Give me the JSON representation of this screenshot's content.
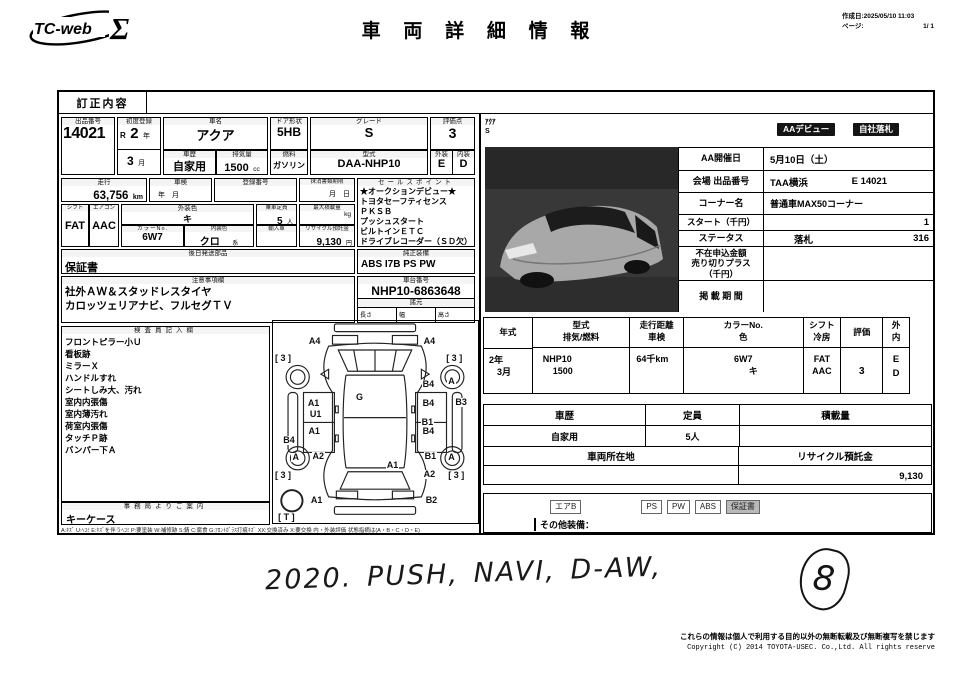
{
  "header": {
    "logo_text": "TC-web",
    "logo_sigma": "Σ",
    "title": "車 両 詳 細 情 報",
    "created": "作成日:2025/05/10 11:03",
    "page_label": "ページ:",
    "page_value": "1/ 1"
  },
  "correction": {
    "label": "訂正内容"
  },
  "left": {
    "exhibit_no": {
      "label": "出品番号",
      "value": "14021"
    },
    "first_reg": {
      "label": "初度登録",
      "era": "R",
      "year": "2",
      "year_unit": "年",
      "month": "3",
      "month_unit": "月"
    },
    "car_name": {
      "label": "車名",
      "value": "アクア"
    },
    "door": {
      "label": "ドア形状",
      "value": "5HB"
    },
    "grade": {
      "label": "グレード",
      "value": "S"
    },
    "score": {
      "label": "評価点",
      "value": "3"
    },
    "ext_grade": {
      "label": "外装",
      "value": "E"
    },
    "int_grade": {
      "label": "内装",
      "value": "D"
    },
    "history": {
      "label": "車歴",
      "value": "自家用"
    },
    "displacement": {
      "label": "排気量",
      "value": "1500",
      "unit": "cc"
    },
    "fuel": {
      "label": "燃料",
      "value": "ガソリン"
    },
    "model": {
      "label": "型式",
      "value": "DAA-NHP10"
    },
    "mileage": {
      "label": "走行",
      "value": "63,756",
      "unit": "km"
    },
    "shaken": {
      "label": "車検",
      "value": "年　月"
    },
    "reg_no": {
      "label": "登録番号",
      "value": ""
    },
    "doc_limit": {
      "label": "抹消書類期限",
      "value": "月　日"
    },
    "sales_points": {
      "label": "セールスポイント",
      "lines": [
        "★オークションデビュー★",
        "トヨタセーフティセンス",
        "ＰＫＳＢ",
        "プッシュスタート",
        "ビルトインＥＴＣ",
        "ドライブレコーダー（ＳＤ欠）"
      ]
    },
    "shift": {
      "label": "シフト",
      "value": "FAT"
    },
    "aircon": {
      "label": "エアコン",
      "value": "AAC"
    },
    "ext_color": {
      "label": "外装色",
      "value": "キ"
    },
    "capacity": {
      "label": "乗車定員",
      "value": "5",
      "unit": "人"
    },
    "max_load": {
      "label": "最大積載量",
      "unit": "kg"
    },
    "color_no": {
      "label": "カラーNo.",
      "value": "6W7"
    },
    "int_color": {
      "label": "内装色",
      "value": "クロ",
      "unit": "系"
    },
    "imported": {
      "label": "輸入車",
      "value": ""
    },
    "recycle_fee": {
      "label": "リサイクル預託金",
      "value": "9,130",
      "unit": "円"
    },
    "later_parts": {
      "label": "後日発送部品",
      "value": "保証書"
    },
    "factory_equip": {
      "label": "純正装備",
      "value": "ABS I7B PS PW"
    },
    "notes": {
      "label": "注意事項欄",
      "lines": [
        "社外ＡＷ＆スタッドレスタイヤ",
        "カロッツェリアナビ、フルセグＴＶ"
      ]
    },
    "chassis": {
      "label": "車台番号",
      "value": "NHP10-6863648"
    },
    "dims": {
      "label": "諸元",
      "length": "長さ",
      "width": "幅",
      "height": "高さ"
    },
    "inspector": {
      "label": "検査員記入欄",
      "lines": [
        "フロントピラー小Ｕ",
        "看板跡",
        "ミラーＸ",
        "ハンドルすれ",
        "シートしみ大、汚れ",
        "室内内張傷",
        "室内薄汚れ",
        "荷室内張傷",
        "タッチＰ跡",
        "バンパー下Ａ"
      ]
    },
    "office": {
      "label": "事務局よりご案内",
      "value": "キーケース"
    },
    "legend": "A:ｷｽﾞ U:ﾍｺﾐ E:ｷｽﾞを伴うﾍｺﾐ P:要塗装 W:補修跡 S:錆 C:腐食 G:ﾌﾛﾝﾄｶﾞﾗｽ打痕ｷｽﾞ XX:交換済み X:要交換  内・外装評価  状態指摘は(A・B・C・D・E)"
  },
  "diagram": {
    "marks": [
      {
        "t": "A4",
        "x": 17,
        "y": 8
      },
      {
        "t": "A4",
        "x": 73,
        "y": 8
      },
      {
        "t": "[ 3 ]",
        "x": 0.5,
        "y": 16.5
      },
      {
        "t": "[ 3 ]",
        "x": 84,
        "y": 16.5
      },
      {
        "t": "B4",
        "x": 72.5,
        "y": 29
      },
      {
        "t": "A",
        "x": 85,
        "y": 27.5
      },
      {
        "t": "G",
        "x": 40,
        "y": 35.5
      },
      {
        "t": "A1",
        "x": 16.5,
        "y": 38.5
      },
      {
        "t": "B4",
        "x": 72.5,
        "y": 38.5
      },
      {
        "t": "B3",
        "x": 88.5,
        "y": 38
      },
      {
        "t": "U1",
        "x": 17.5,
        "y": 44
      },
      {
        "t": "B1",
        "x": 72,
        "y": 48
      },
      {
        "t": "A1",
        "x": 16.8,
        "y": 52.5
      },
      {
        "t": "B4",
        "x": 72.5,
        "y": 52.5
      },
      {
        "t": "B4",
        "x": 4.5,
        "y": 57
      },
      {
        "t": "A",
        "x": 9,
        "y": 65.5
      },
      {
        "t": "A2",
        "x": 18.8,
        "y": 65
      },
      {
        "t": "B1",
        "x": 73.5,
        "y": 65
      },
      {
        "t": "A",
        "x": 85,
        "y": 65.5
      },
      {
        "t": "A1",
        "x": 55,
        "y": 69.5
      },
      {
        "t": "A2",
        "x": 73,
        "y": 74
      },
      {
        "t": "[ 3 ]",
        "x": 0.5,
        "y": 74.5
      },
      {
        "t": "[ 3 ]",
        "x": 85,
        "y": 74.5
      },
      {
        "t": "A1",
        "x": 18,
        "y": 86.5
      },
      {
        "t": "B2",
        "x": 74,
        "y": 86.5
      },
      {
        "t": "[ T ]",
        "x": 2,
        "y": 95
      }
    ]
  },
  "right": {
    "caption_model": "ｱｸｱ",
    "caption_grade": "S",
    "badge1": "AAデビュー",
    "badge2": "自社落札",
    "auction": [
      {
        "label": "AA開催日",
        "value": "5月10日（土）",
        "value2": ""
      },
      {
        "label": "会場 出品番号",
        "value": "TAA横浜",
        "value2": "E 14021"
      },
      {
        "label": "コーナー名",
        "value": "普通車MAX50コーナー",
        "value2": ""
      },
      {
        "label": "スタート（千円）",
        "value": "",
        "value2": "1"
      },
      {
        "label": "ステータス",
        "value": "落札",
        "value2": "316"
      },
      {
        "label": "不在申込金額\n売り切りプラス\n（千円）",
        "value": "",
        "value2": ""
      },
      {
        "label": "掲 載 期 間",
        "value": "",
        "value2": ""
      }
    ],
    "spec": {
      "h_year": "年式",
      "h_model": "型式",
      "h_disp": "排気/燃料",
      "h_mileage": "走行距離",
      "h_shaken": "車検",
      "h_colorno": "カラーNo.",
      "h_color": "色",
      "h_shift": "シフト",
      "h_ac": "冷房",
      "h_score": "評価",
      "h_ext": "外",
      "h_int": "内",
      "v_year1": "2年",
      "v_year2": "3月",
      "v_model": "NHP10",
      "v_disp": "1500",
      "v_mileage": "64千km",
      "v_colorno": "6W7",
      "v_color": "キ",
      "v_shift": "FAT",
      "v_ac": "AAC",
      "v_score": "3",
      "v_ext": "E",
      "v_int": "D"
    },
    "usage": {
      "h_history": "車歴",
      "h_capacity": "定員",
      "h_load": "積載量",
      "v_history": "自家用",
      "v_capacity": "5人",
      "v_load": "",
      "h_location": "車両所在地",
      "h_recycle": "リサイクル預託金",
      "v_location": "",
      "v_recycle": "9,130"
    },
    "equip": {
      "badges": [
        "エアB",
        "PS",
        "PW",
        "ABS",
        "保証書"
      ],
      "other_label": "その他装備："
    }
  },
  "handwriting": {
    "note": "2020.  PUSH,  NAVI,  D-AW,",
    "mark": "8"
  },
  "footer": {
    "line1": "これらの情報は個人で利用する目的以外の無断転載及び無断複写を禁じます",
    "line2": "Copyright (C) 2014 TOYOTA-USEC. Co.,Ltd. All rights reserve"
  }
}
